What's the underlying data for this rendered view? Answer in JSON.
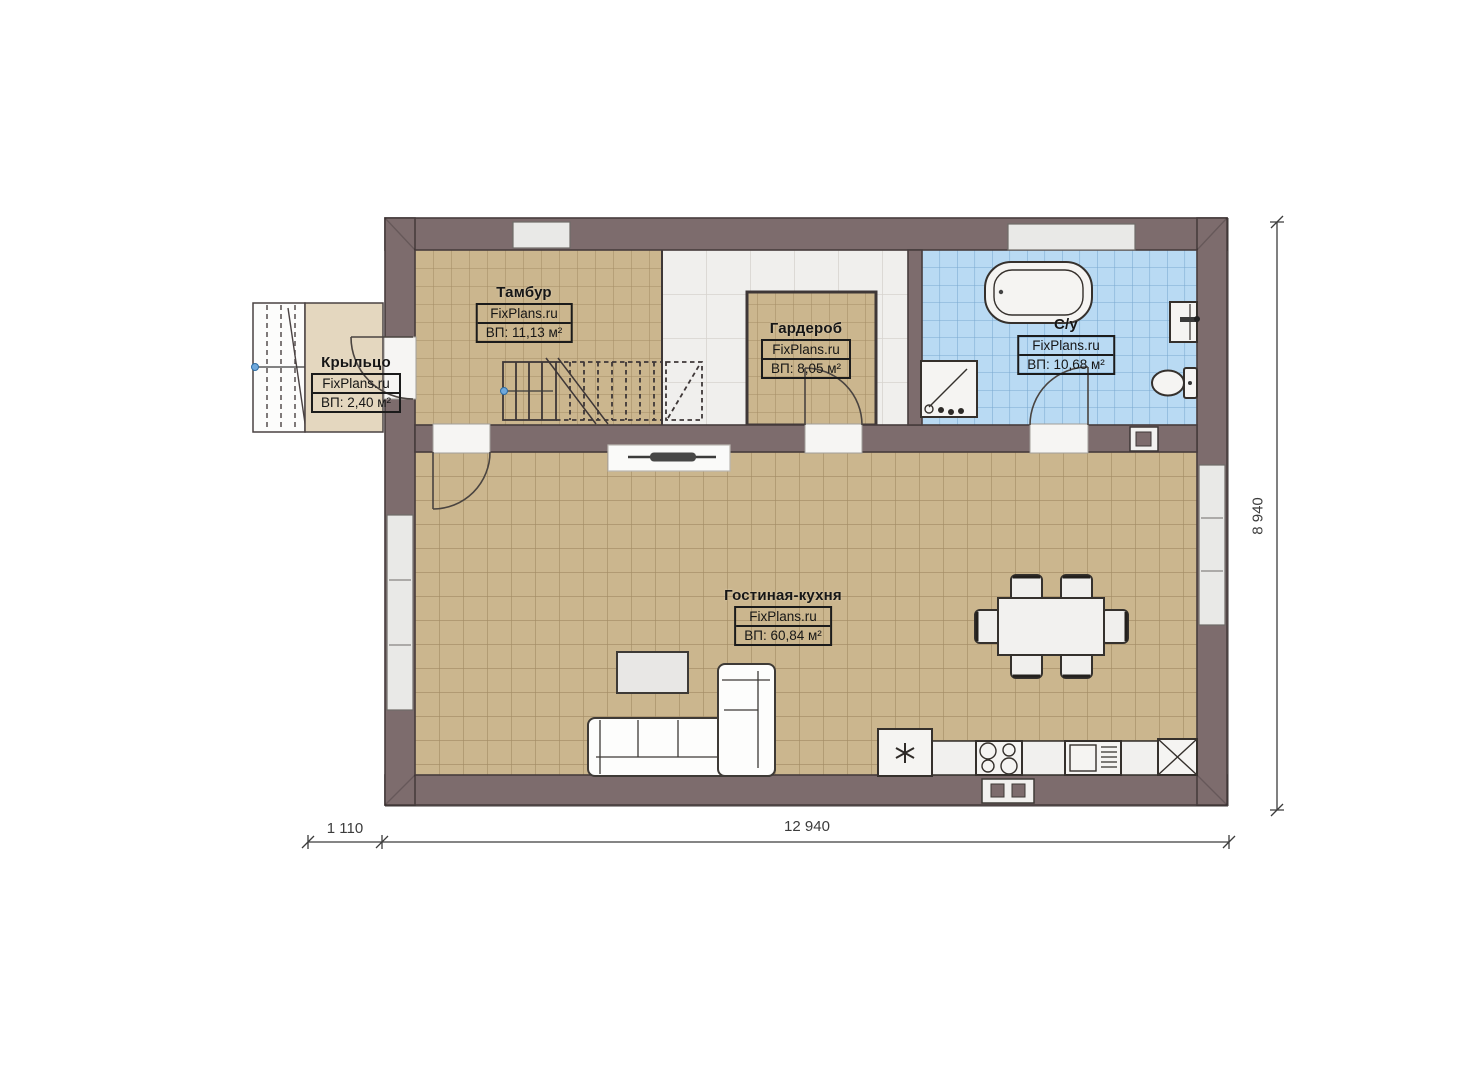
{
  "brand": "FixPlans.ru",
  "rooms": [
    {
      "id": "tambur",
      "name": "Тамбур",
      "brand": "FixPlans.ru",
      "area": "ВП: 11,13 м²"
    },
    {
      "id": "garderob",
      "name": "Гардероб",
      "brand": "FixPlans.ru",
      "area": "ВП: 8,05 м²"
    },
    {
      "id": "su",
      "name": "С/у",
      "brand": "FixPlans.ru",
      "area": "ВП: 10,68 м²"
    },
    {
      "id": "living",
      "name": "Гостиная-кухня",
      "brand": "FixPlans.ru",
      "area": "ВП: 60,84 м²"
    },
    {
      "id": "krylco",
      "name": "Крыльцо",
      "brand": "FixPlans.ru",
      "area": "ВП: 2,40 м²"
    }
  ],
  "dimensions": {
    "porch_depth": "1 110",
    "house_width": "12 940",
    "house_height": "8 940"
  },
  "colors": {
    "wall": "#7d6c6d",
    "wall-edge": "#473c3d",
    "floor-tan": "#cbb68e",
    "floor-tan-line": "#9b835c",
    "floor-blue": "#b9daf3",
    "floor-blue-line": "#7aa9d0",
    "tile-white": "#f0efed",
    "tile-white-line": "#d7d4cf",
    "porch": "#e4d7bf",
    "fixture": "#f5f4f2",
    "ink": "#161616",
    "dim": "#3c3c3c",
    "accent-dot": "#6fa8dc"
  }
}
